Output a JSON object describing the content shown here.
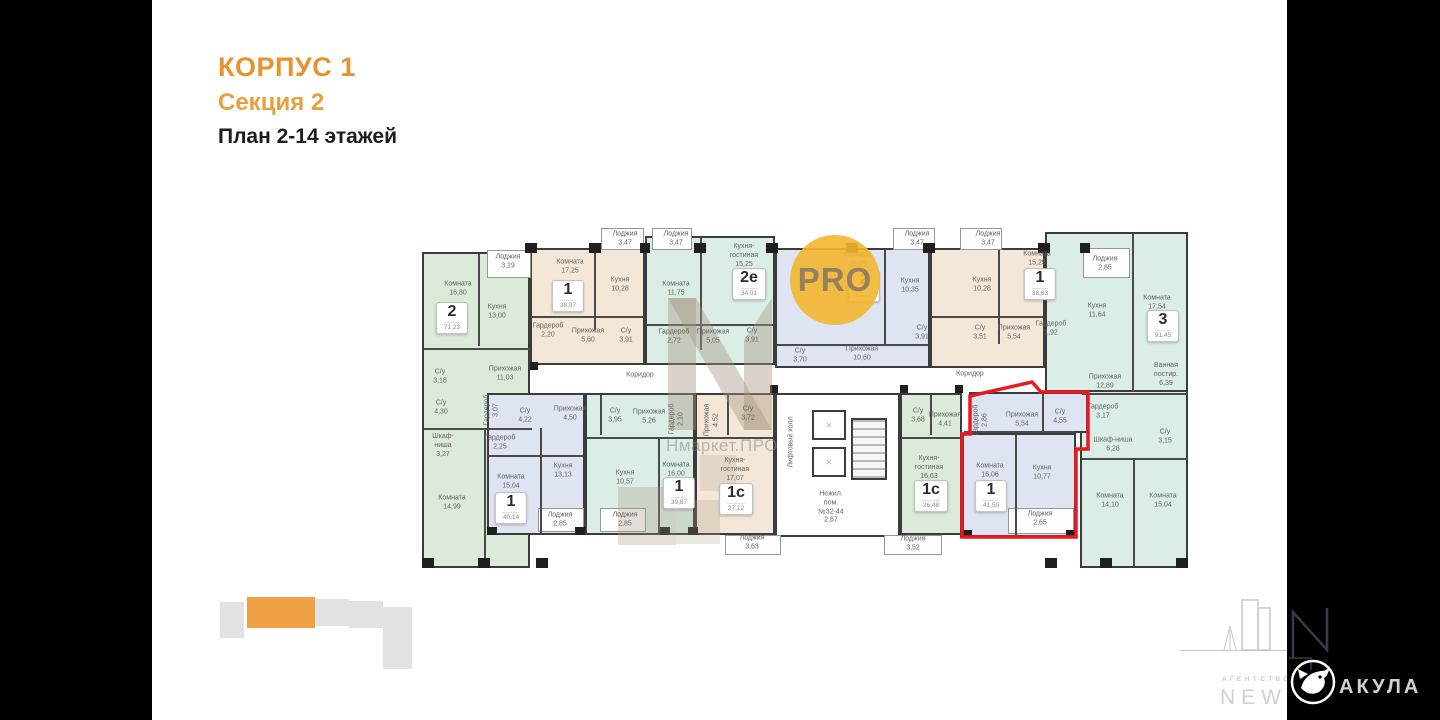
{
  "header": {
    "building": "КОРПУС 1",
    "section": "Секция 2",
    "plan": "План 2-14 этажей"
  },
  "watermarks": {
    "pro": "PRO",
    "nmarket": "Нмаркет.ПРО"
  },
  "footer": {
    "agency_label": "АГЕНТСТВО",
    "agency_name": "NEW",
    "shark_name": "АКУЛА"
  },
  "colors": {
    "accent_orange": "#E8922E",
    "highlight_red": "#E8191F",
    "fill_green": "#DCEAD9",
    "fill_beige": "#F4E7D7",
    "fill_teal": "#DAEEE5",
    "fill_blue": "#DFE4F3",
    "wall": "#3C3C3C",
    "watermark_yellow": "#F3B630"
  },
  "plan": {
    "units": [
      {
        "x": 452,
        "y": 318,
        "num": "2",
        "area": "71,23"
      },
      {
        "x": 568,
        "y": 296,
        "num": "1",
        "area": "38,97"
      },
      {
        "x": 749,
        "y": 284,
        "num": "2е",
        "area": "34,91"
      },
      {
        "x": 864,
        "y": 286,
        "num": "2",
        "area": "56,57"
      },
      {
        "x": 1040,
        "y": 284,
        "num": "1",
        "area": "38,63"
      },
      {
        "x": 1163,
        "y": 326,
        "num": "3",
        "area": "91,45"
      },
      {
        "x": 511,
        "y": 508,
        "num": "1",
        "area": "40,14"
      },
      {
        "x": 679,
        "y": 493,
        "num": "1",
        "area": "39,87"
      },
      {
        "x": 736,
        "y": 499,
        "num": "1с",
        "area": "27,12"
      },
      {
        "x": 931,
        "y": 496,
        "num": "1с",
        "area": "26,48"
      },
      {
        "x": 991,
        "y": 496,
        "num": "1",
        "area": "41,50",
        "highlight": true
      }
    ],
    "labels": [
      {
        "x": 508,
        "y": 262,
        "lines": [
          "Лоджия",
          "3,19"
        ]
      },
      {
        "x": 458,
        "y": 289,
        "lines": [
          "Комната",
          "16,80"
        ]
      },
      {
        "x": 497,
        "y": 312,
        "lines": [
          "Кухня",
          "13,00"
        ]
      },
      {
        "x": 440,
        "y": 377,
        "lines": [
          "С/у",
          "3,18"
        ]
      },
      {
        "x": 505,
        "y": 374,
        "lines": [
          "Прихожая",
          "11,03"
        ]
      },
      {
        "x": 441,
        "y": 408,
        "lines": [
          "С/у",
          "4,30"
        ]
      },
      {
        "x": 492,
        "y": 410,
        "lines": [
          "Гардероб",
          "3,07"
        ],
        "vert": true
      },
      {
        "x": 443,
        "y": 446,
        "lines": [
          "Шкаф-",
          "ниша",
          "3,27"
        ]
      },
      {
        "x": 452,
        "y": 503,
        "lines": [
          "Комната",
          "14,99"
        ]
      },
      {
        "x": 625,
        "y": 239,
        "lines": [
          "Лоджия",
          "3,47"
        ]
      },
      {
        "x": 676,
        "y": 239,
        "lines": [
          "Лоджия",
          "3,47"
        ]
      },
      {
        "x": 570,
        "y": 267,
        "lines": [
          "Комната",
          "17,25"
        ]
      },
      {
        "x": 620,
        "y": 285,
        "lines": [
          "Кухня",
          "10,28"
        ]
      },
      {
        "x": 548,
        "y": 331,
        "lines": [
          "Гардероб",
          "2,20"
        ]
      },
      {
        "x": 588,
        "y": 336,
        "lines": [
          "Прихожая",
          "5,60"
        ]
      },
      {
        "x": 626,
        "y": 336,
        "lines": [
          "С/у",
          "3,91"
        ]
      },
      {
        "x": 676,
        "y": 289,
        "lines": [
          "Комната",
          "11,75"
        ]
      },
      {
        "x": 744,
        "y": 256,
        "lines": [
          "Кухня-",
          "гостиная",
          "15,25"
        ]
      },
      {
        "x": 674,
        "y": 337,
        "lines": [
          "Гардероб",
          "2,72"
        ]
      },
      {
        "x": 713,
        "y": 337,
        "lines": [
          "Прихожая",
          "5,05"
        ]
      },
      {
        "x": 752,
        "y": 336,
        "lines": [
          "С/у",
          "3,91"
        ]
      },
      {
        "x": 858,
        "y": 260,
        "lines": [
          "Комната",
          "16,05"
        ]
      },
      {
        "x": 917,
        "y": 239,
        "lines": [
          "Лоджия",
          "3,47"
        ]
      },
      {
        "x": 910,
        "y": 286,
        "lines": [
          "Кухня",
          "10,35"
        ]
      },
      {
        "x": 800,
        "y": 356,
        "lines": [
          "С/у",
          "3,70"
        ]
      },
      {
        "x": 922,
        "y": 333,
        "lines": [
          "С/у",
          "3,91"
        ]
      },
      {
        "x": 862,
        "y": 354,
        "lines": [
          "Прихожая",
          "10,60"
        ]
      },
      {
        "x": 988,
        "y": 239,
        "lines": [
          "Лоджия",
          "3,47"
        ]
      },
      {
        "x": 982,
        "y": 285,
        "lines": [
          "Кухня",
          "10,28"
        ]
      },
      {
        "x": 1037,
        "y": 259,
        "lines": [
          "Комната",
          "15,25"
        ]
      },
      {
        "x": 980,
        "y": 333,
        "lines": [
          "С/у",
          "3,51"
        ]
      },
      {
        "x": 1014,
        "y": 333,
        "lines": [
          "Прихожая",
          "5,54"
        ]
      },
      {
        "x": 1051,
        "y": 329,
        "lines": [
          "Гардероб",
          "1,92"
        ]
      },
      {
        "x": 1105,
        "y": 264,
        "lines": [
          "Лоджия",
          "2,85"
        ]
      },
      {
        "x": 1097,
        "y": 311,
        "lines": [
          "Кухня",
          "11,64"
        ]
      },
      {
        "x": 1157,
        "y": 303,
        "lines": [
          "Комната",
          "17,54"
        ]
      },
      {
        "x": 1105,
        "y": 382,
        "lines": [
          "Прихожая",
          "12,89"
        ]
      },
      {
        "x": 1166,
        "y": 375,
        "lines": [
          "Ванная",
          "постир.",
          "6,39"
        ]
      },
      {
        "x": 1103,
        "y": 412,
        "lines": [
          "Гардероб",
          "3,17"
        ]
      },
      {
        "x": 1113,
        "y": 445,
        "lines": [
          "Шкаф-ниша",
          "6,28"
        ]
      },
      {
        "x": 1165,
        "y": 437,
        "lines": [
          "С/у",
          "3,15"
        ]
      },
      {
        "x": 1110,
        "y": 501,
        "lines": [
          "Комната",
          "14,10"
        ]
      },
      {
        "x": 1163,
        "y": 501,
        "lines": [
          "Комната",
          "15,04"
        ]
      },
      {
        "x": 525,
        "y": 416,
        "lines": [
          "С/у",
          "4,22"
        ]
      },
      {
        "x": 570,
        "y": 414,
        "lines": [
          "Прихожая",
          "4,50"
        ]
      },
      {
        "x": 500,
        "y": 443,
        "lines": [
          "Гардероб",
          "2,25"
        ]
      },
      {
        "x": 563,
        "y": 471,
        "lines": [
          "Кухня",
          "13,13"
        ]
      },
      {
        "x": 511,
        "y": 482,
        "lines": [
          "Комната",
          "15,04"
        ]
      },
      {
        "x": 560,
        "y": 520,
        "lines": [
          "Лоджия",
          "2,85"
        ]
      },
      {
        "x": 615,
        "y": 416,
        "lines": [
          "С/у",
          "3,95"
        ]
      },
      {
        "x": 649,
        "y": 417,
        "lines": [
          "Прихожая",
          "5,26"
        ]
      },
      {
        "x": 677,
        "y": 419,
        "lines": [
          "Гардероб",
          "2,10"
        ],
        "vert": true
      },
      {
        "x": 625,
        "y": 478,
        "lines": [
          "Кухня",
          "10,57"
        ]
      },
      {
        "x": 676,
        "y": 470,
        "lines": [
          "Комната",
          "16,00"
        ]
      },
      {
        "x": 625,
        "y": 520,
        "lines": [
          "Лоджия",
          "2,85"
        ]
      },
      {
        "x": 712,
        "y": 420,
        "lines": [
          "Прихожая",
          "4,52"
        ],
        "vert": true
      },
      {
        "x": 748,
        "y": 414,
        "lines": [
          "С/у",
          "3,72"
        ]
      },
      {
        "x": 735,
        "y": 470,
        "lines": [
          "Кухня-",
          "гостиная",
          "17,07"
        ]
      },
      {
        "x": 752,
        "y": 543,
        "lines": [
          "Лоджия",
          "3,63"
        ]
      },
      {
        "x": 792,
        "y": 442,
        "lines": [
          "Лифтовый холл"
        ],
        "vert": true
      },
      {
        "x": 831,
        "y": 508,
        "lines": [
          "Нежил.",
          "пом.",
          "№32-44",
          "2,67"
        ]
      },
      {
        "x": 918,
        "y": 416,
        "lines": [
          "С/у",
          "3,68"
        ]
      },
      {
        "x": 945,
        "y": 420,
        "lines": [
          "Прихожая",
          "4,41"
        ]
      },
      {
        "x": 929,
        "y": 468,
        "lines": [
          "Кухня-",
          "гостиная",
          "16,63"
        ]
      },
      {
        "x": 913,
        "y": 544,
        "lines": [
          "Лоджия",
          "3,52"
        ]
      },
      {
        "x": 981,
        "y": 420,
        "lines": [
          "Гардероб",
          "2,86"
        ],
        "vert": true
      },
      {
        "x": 1022,
        "y": 420,
        "lines": [
          "Прихожая",
          "5,54"
        ]
      },
      {
        "x": 1060,
        "y": 417,
        "lines": [
          "С/у",
          "4,55"
        ]
      },
      {
        "x": 990,
        "y": 471,
        "lines": [
          "Комната",
          "16,06"
        ]
      },
      {
        "x": 1042,
        "y": 473,
        "lines": [
          "Кухня",
          "10,77"
        ]
      },
      {
        "x": 1040,
        "y": 519,
        "lines": [
          "Лоджия",
          "2,65"
        ]
      },
      {
        "x": 640,
        "y": 376,
        "lines": [
          "Коридор"
        ]
      },
      {
        "x": 970,
        "y": 375,
        "lines": [
          "Коридор"
        ]
      }
    ]
  }
}
